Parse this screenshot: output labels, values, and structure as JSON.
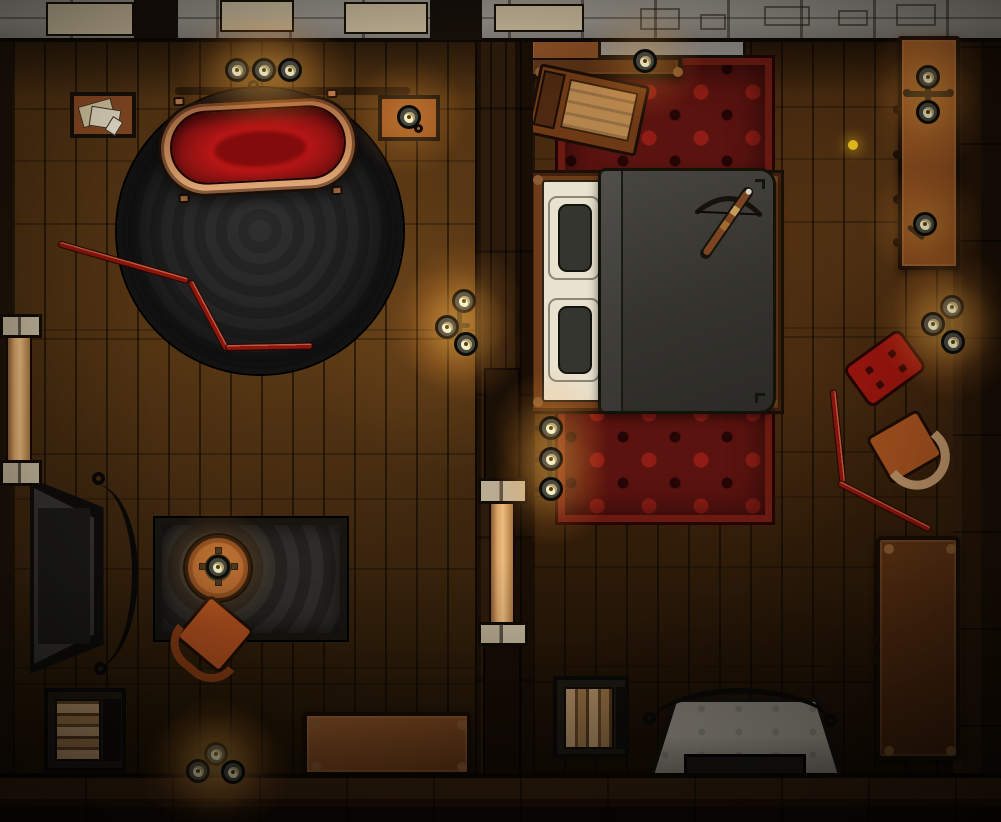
{
  "scene": {
    "type": "top-down battle map",
    "setting": "Two-room wooden inn suite at night: bath parlor (left) and bedroom (right), stone north wall, plank floors",
    "notable": "Copper bathtub filled with blood on a round dark rug; a crossbow rests on the bed"
  },
  "palette": {
    "stone_block": "#c9ba9b",
    "rug_red": "#5a130f",
    "copper": "#c68a58",
    "blood": "#8c1212",
    "blood_bright": "#c01616",
    "blanket": "#3a3934",
    "sheet": "#e9e2cf",
    "pillow": "#35352f",
    "chair_orange": "#b4511e",
    "armchair_orange": "#a8531f",
    "stool_red": "#9c150e",
    "rod_red": "#8c150d",
    "candle_flame": "#f7eec4",
    "firewood": "#c8a172",
    "light_marker": "#ffd21e"
  },
  "labels": {
    "map": "Top-down inn rooms battle map",
    "north_wall": "Stone wall",
    "center_wall": "Dividing wall",
    "right_wall": "East wall",
    "bottom_wall": "South wall",
    "left_room": "Bath parlor floor",
    "right_room": "Bedroom floor",
    "bathtub": "Copper bathtub filled with blood",
    "round_rug": "Round dark rug",
    "candelabra": "Triple candle stand",
    "paper_table": "Tray with loose papers",
    "wall_shelf": "Candle shelf",
    "poker": "Bent red fire poker",
    "fireplace": "Fireplace with fender",
    "hearth_rug": "Dark patterned rug",
    "side_table": "Round side table with candle",
    "chair": "Orange armchair",
    "firewood": "Firewood box",
    "bench": "Wooden bench",
    "bed": "Double bed",
    "pillow": "Pillow",
    "blanket": "Grey blanket",
    "crossbow": "Crossbow",
    "dresser": "Dresser with metal handle",
    "trunk": "Open travel trunk",
    "bed_rug": "Red floral rug",
    "sideboard": "Tall candle sideboard",
    "stool": "Red padded stool",
    "long_table": "Long side table",
    "post": "Timber support post",
    "candle": "Lit candle",
    "light_marker": "Light source marker"
  },
  "lights": {
    "marker": {
      "x": 853,
      "y": 145,
      "color": "#ffd21e"
    },
    "candles": [
      {
        "x": 237,
        "y": 70
      },
      {
        "x": 264,
        "y": 70
      },
      {
        "x": 290,
        "y": 70
      },
      {
        "x": 409,
        "y": 117
      },
      {
        "x": 464,
        "y": 301
      },
      {
        "x": 447,
        "y": 327
      },
      {
        "x": 466,
        "y": 344
      },
      {
        "x": 218,
        "y": 567
      },
      {
        "x": 216,
        "y": 754
      },
      {
        "x": 198,
        "y": 771
      },
      {
        "x": 233,
        "y": 772
      },
      {
        "x": 645,
        "y": 61
      },
      {
        "x": 928,
        "y": 77
      },
      {
        "x": 928,
        "y": 112
      },
      {
        "x": 925,
        "y": 224
      },
      {
        "x": 551,
        "y": 428
      },
      {
        "x": 551,
        "y": 459
      },
      {
        "x": 551,
        "y": 489
      },
      {
        "x": 952,
        "y": 307
      },
      {
        "x": 933,
        "y": 324
      },
      {
        "x": 953,
        "y": 342
      }
    ]
  }
}
